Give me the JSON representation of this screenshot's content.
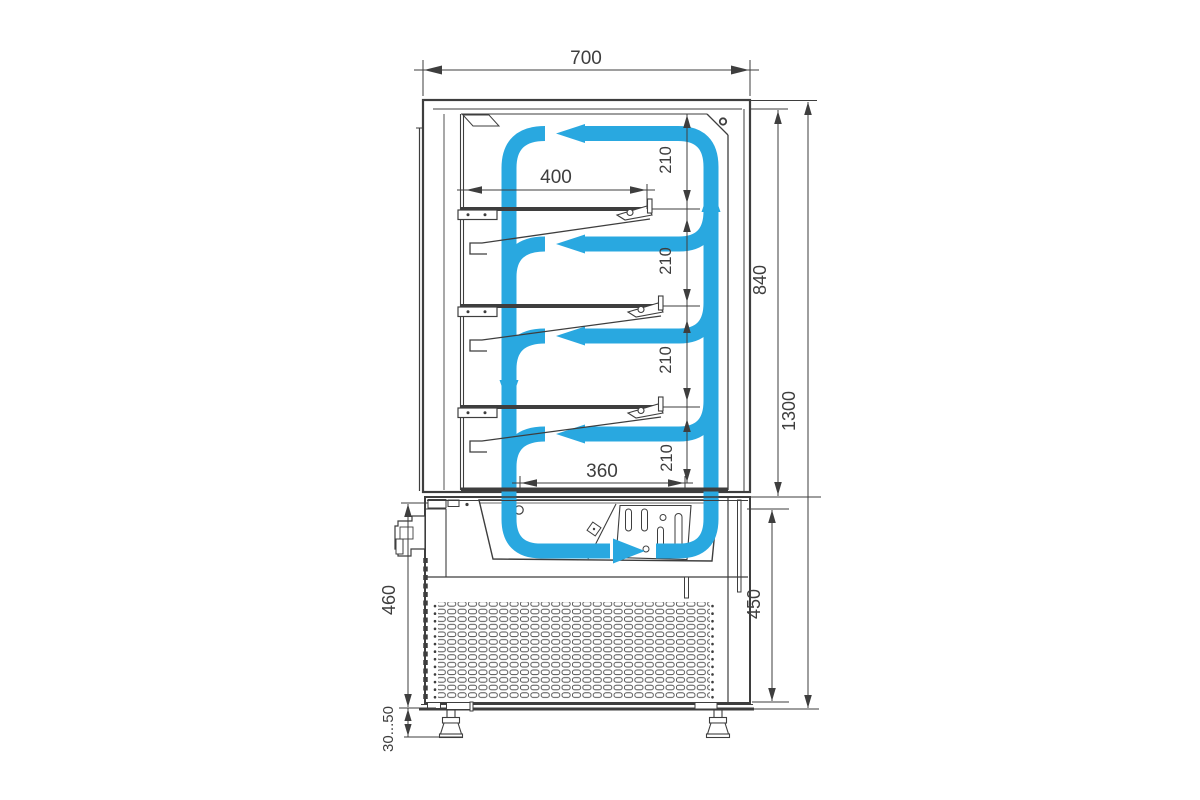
{
  "diagram": {
    "airflow_color": "#29a8e0",
    "line_color": "#3e3e3e",
    "dims": {
      "overall_width": "700",
      "overall_height": "1300",
      "display_section_height": "840",
      "shelf_length": "400",
      "bottom_shelf_length": "360",
      "shelf_spacings": [
        "210",
        "210",
        "210",
        "210"
      ],
      "base_height_front": "460",
      "base_height_back": "450",
      "foot_adjustment_range": "30...50"
    }
  }
}
